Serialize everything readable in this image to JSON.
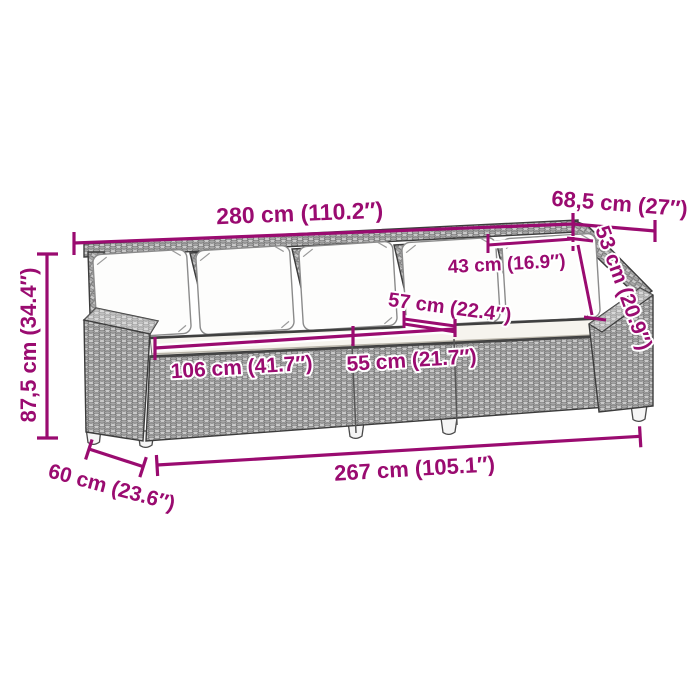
{
  "image": {
    "kind": "product-dimension-diagram",
    "background_color": "#ffffff"
  },
  "product": {
    "name": "poly-rattan-garden-sofa",
    "back_pillow_count": 5,
    "visible_leg_count": 5
  },
  "style": {
    "dimension_color": "#9A0B70",
    "label_halo_color": "#ffffff",
    "wicker_gray": "#a9a9a9",
    "outline_gray": "#3c3c3c",
    "seat_cushion_color": "#f6f4ee",
    "pillow_color": "#fdfdfc"
  },
  "dimensions": {
    "overall_width": {
      "label": "280 cm (110.2″)"
    },
    "overall_depth": {
      "label": "68,5 cm (27″)"
    },
    "backrest_height": {
      "label": "53 cm (20.9″)"
    },
    "back_pillow_width": {
      "label": "43 cm (16.9″)"
    },
    "seat_depth": {
      "label": "57 cm (22.4″)"
    },
    "seat_width_large": {
      "label": "106 cm (41.7″)"
    },
    "seat_width_small": {
      "label": "55 cm (21.7″)"
    },
    "overall_height": {
      "label": "87,5 cm (34.4″)"
    },
    "base_depth": {
      "label": "60 cm (23.6″)"
    },
    "base_width": {
      "label": "267 cm (105.1″)"
    }
  }
}
